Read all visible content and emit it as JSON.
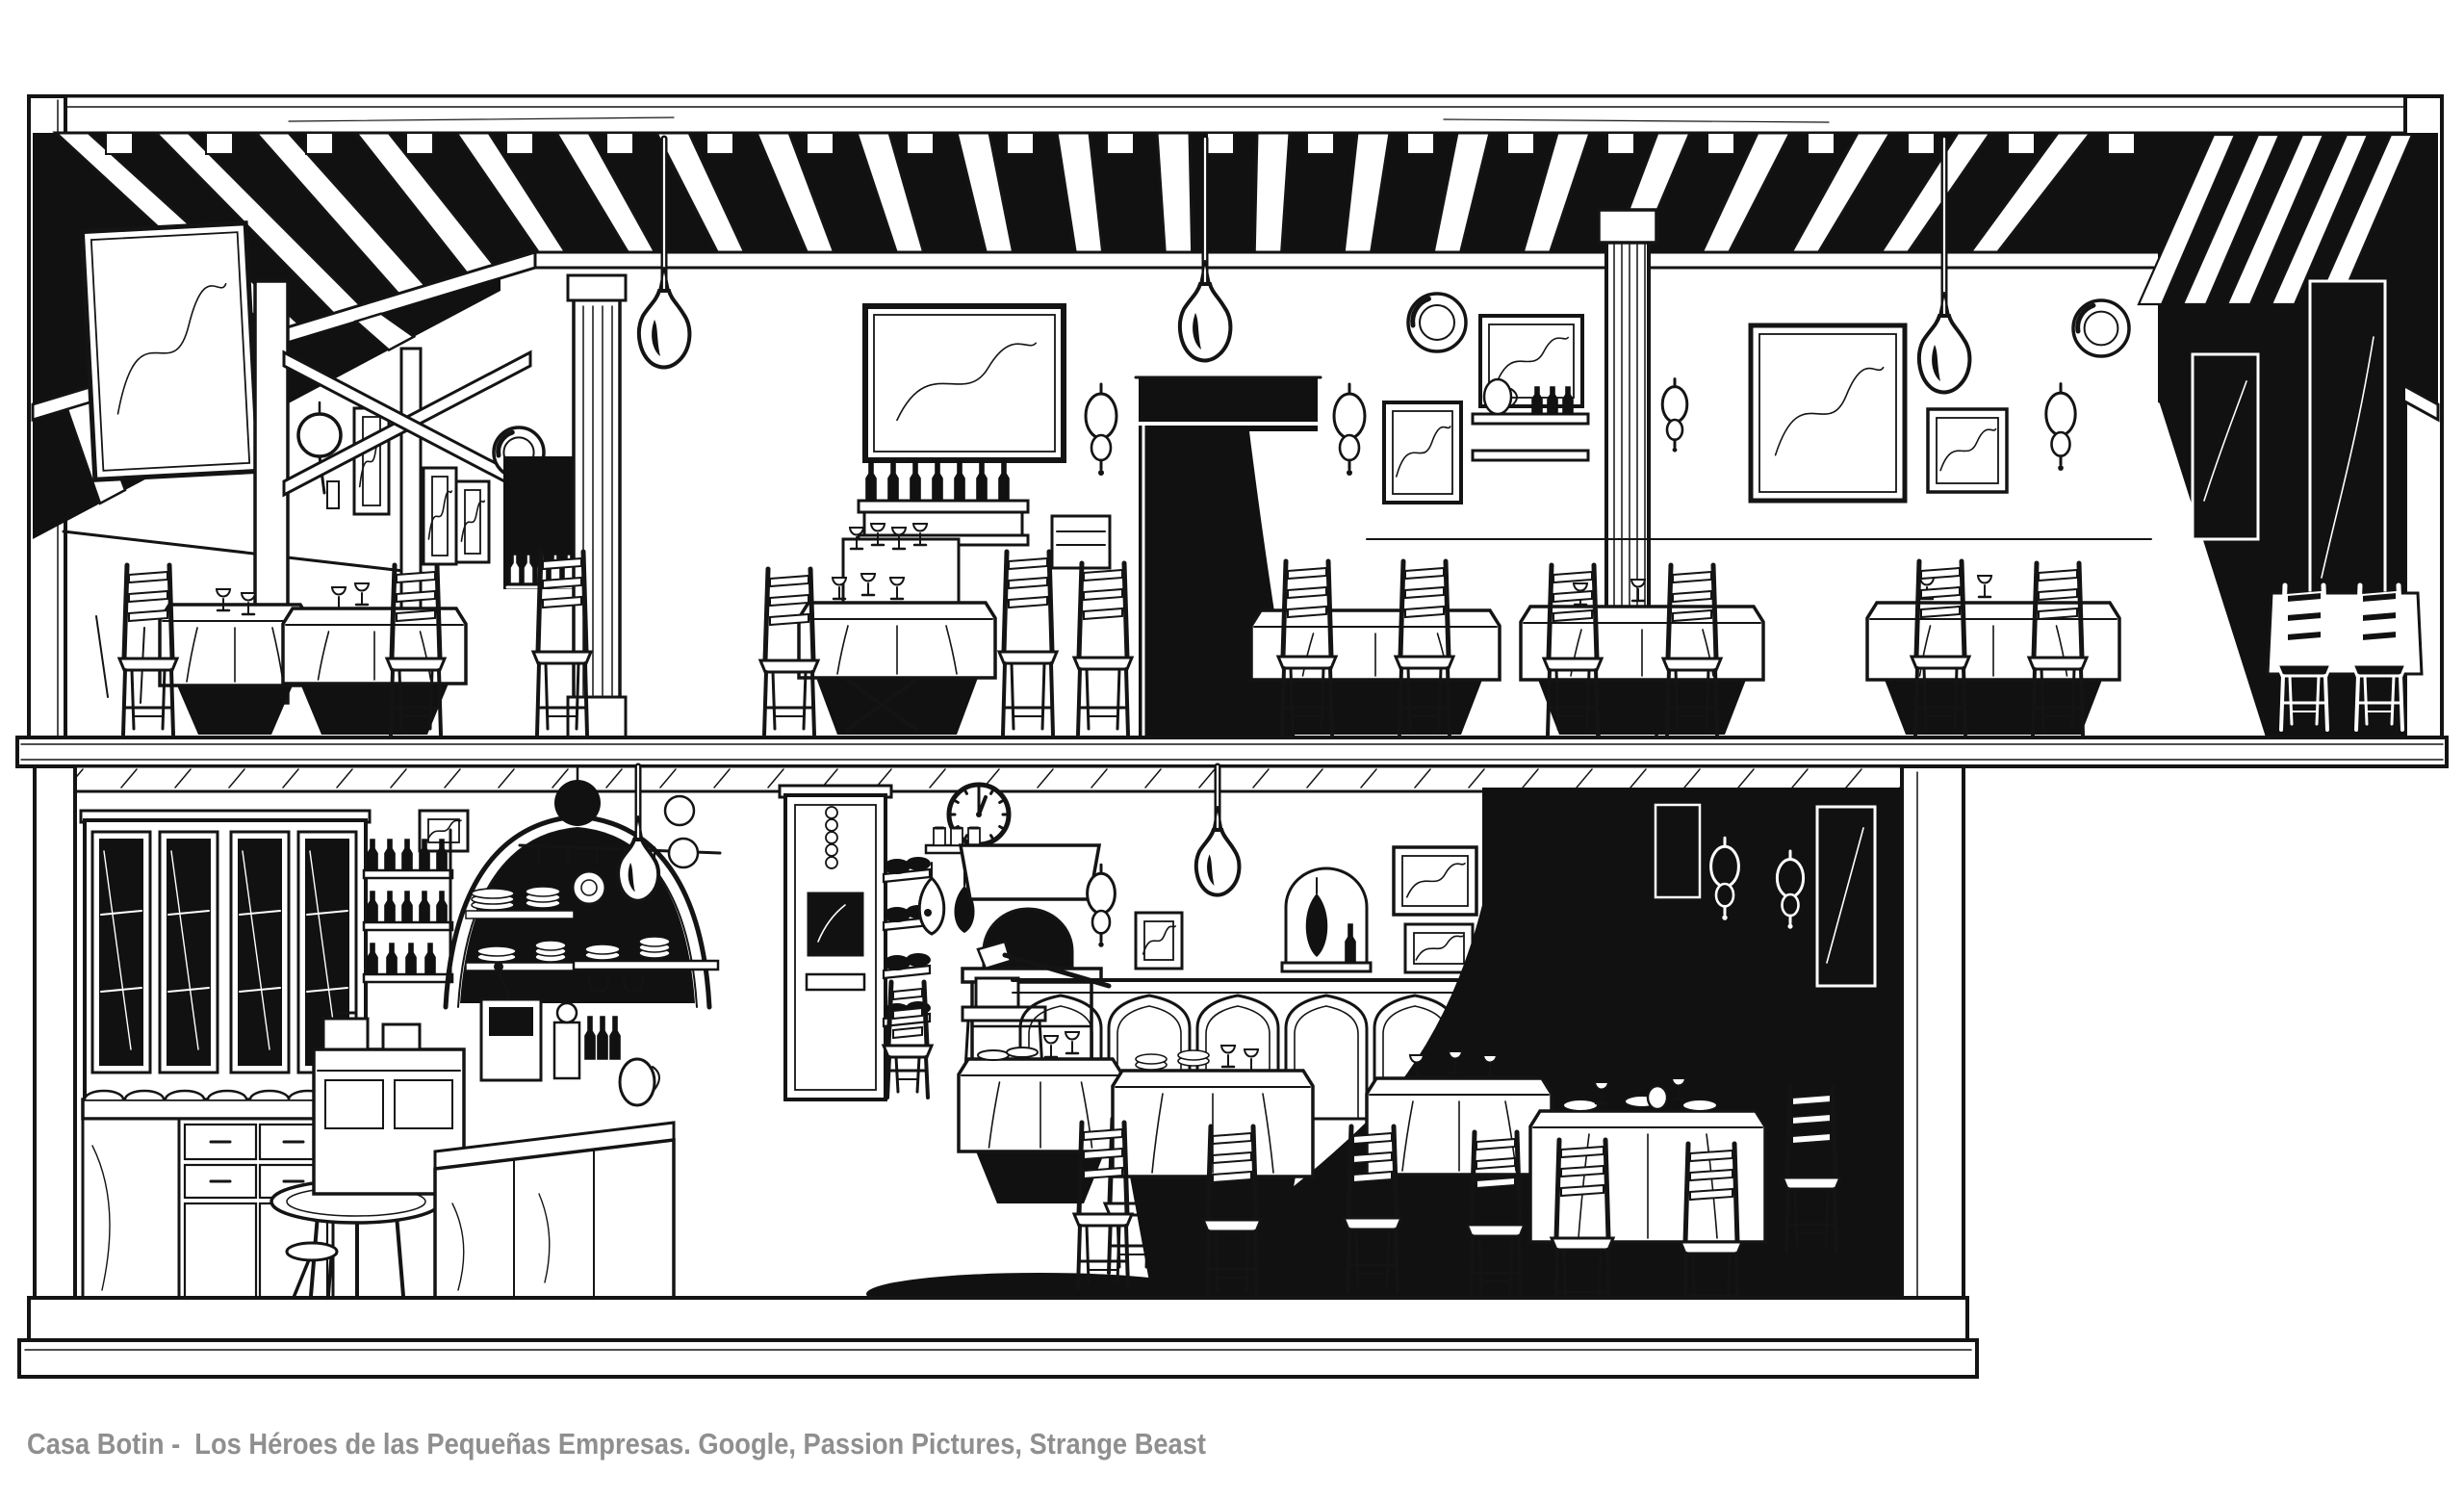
{
  "caption": {
    "text": "Casa Botin -  Los Héroes de las Pequeñas Empresas. Google, Passion Pictures, Strange Beast",
    "color": "#8f8f8f"
  },
  "clock": {
    "time": "12:01"
  },
  "colors": {
    "ink": "#141414",
    "paper": "#ffffff",
    "shadow": "#111111"
  }
}
